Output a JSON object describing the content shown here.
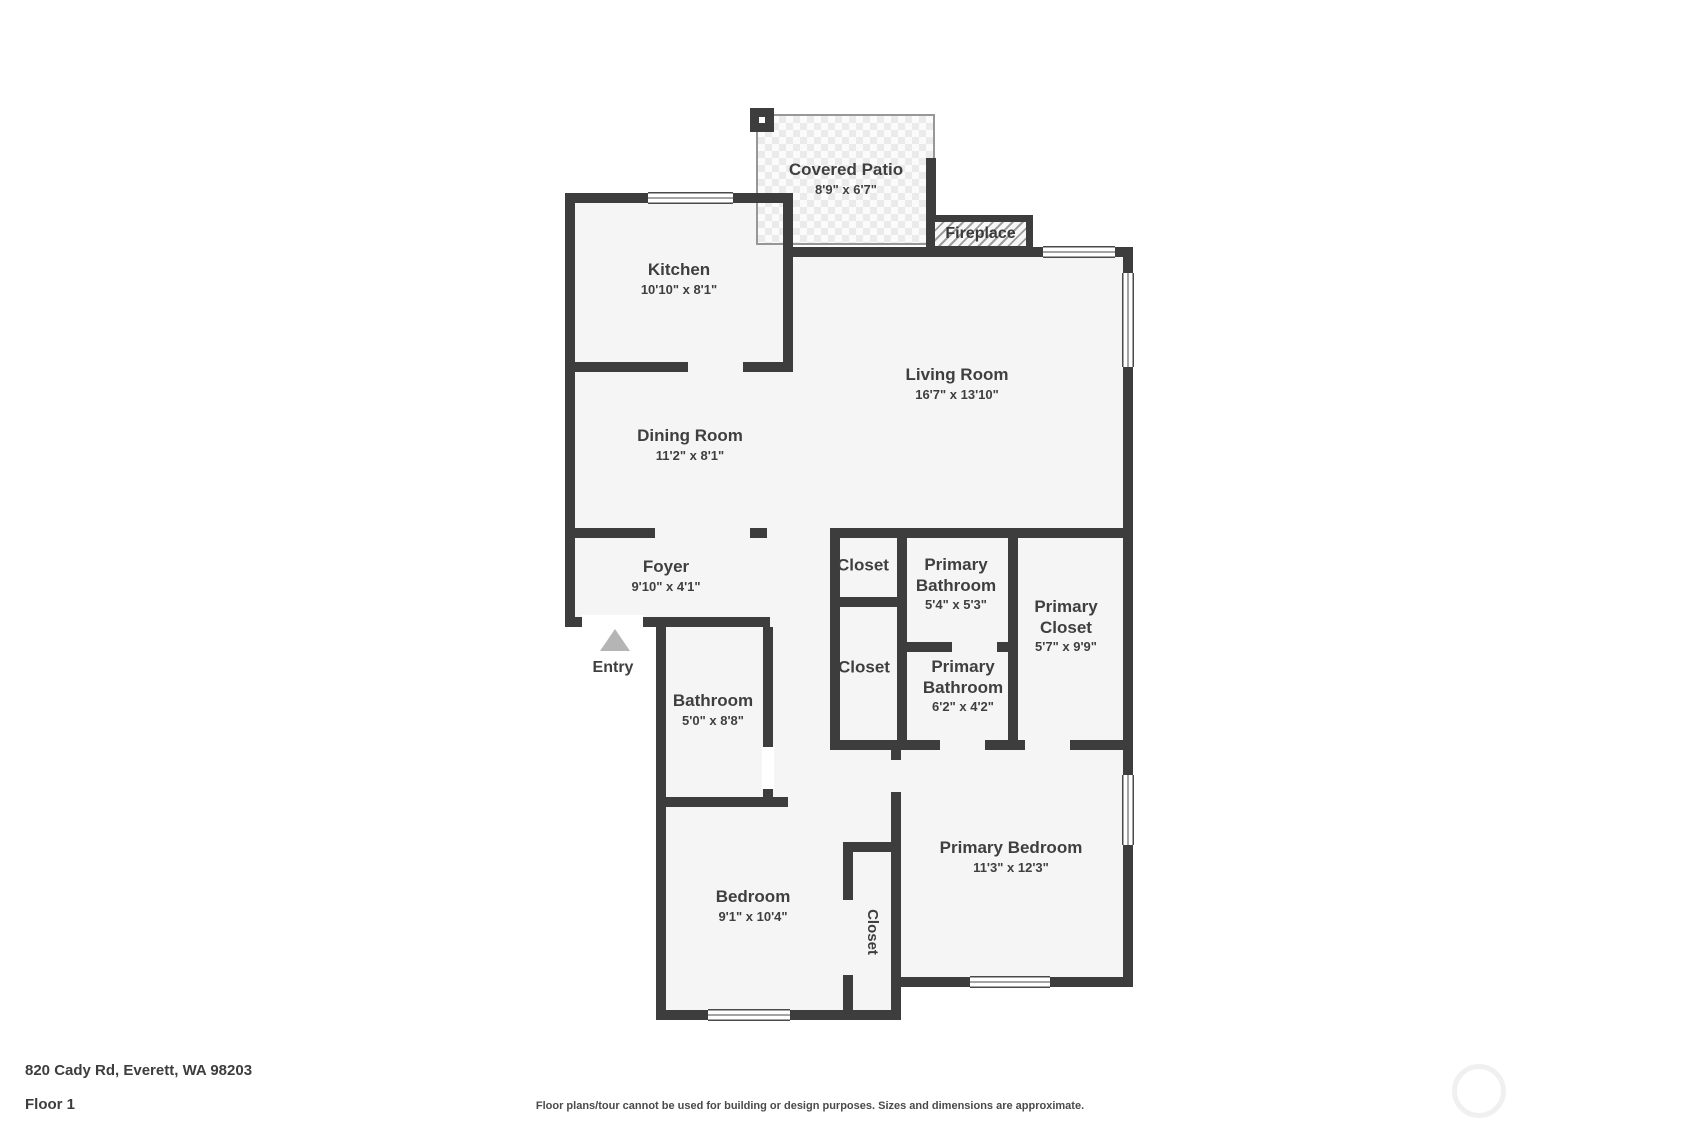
{
  "colors": {
    "wall": "#3d3d3d",
    "room_fill": "#f5f5f5",
    "label_text": "#3f3f3f",
    "entry_arrow": "#b5b5b5",
    "patio_tile": "#ebebeb",
    "watermark_ring": "#f0f0f0"
  },
  "rooms": {
    "covered_patio": {
      "name": "Covered Patio",
      "dims": "8'9\" x 6'7\""
    },
    "fireplace": {
      "name": "Fireplace"
    },
    "kitchen": {
      "name": "Kitchen",
      "dims": "10'10\" x 8'1\""
    },
    "living_room": {
      "name": "Living Room",
      "dims": "16'7\" x 13'10\""
    },
    "dining_room": {
      "name": "Dining Room",
      "dims": "11'2\" x 8'1\""
    },
    "foyer": {
      "name": "Foyer",
      "dims": "9'10\" x 4'1\""
    },
    "entry": {
      "name": "Entry"
    },
    "bathroom": {
      "name": "Bathroom",
      "dims": "5'0\" x 8'8\""
    },
    "closet_upper": {
      "name": "Closet"
    },
    "primary_bathroom_upper": {
      "name": "Primary Bathroom",
      "dims": "5'4\" x 5'3\""
    },
    "primary_closet": {
      "name": "Primary Closet",
      "dims": "5'7\" x 9'9\""
    },
    "closet_lower": {
      "name": "Closet"
    },
    "primary_bathroom_lower": {
      "name": "Primary Bathroom",
      "dims": "6'2\" x 4'2\""
    },
    "bedroom": {
      "name": "Bedroom",
      "dims": "9'1\" x 10'4\""
    },
    "bedroom_closet": {
      "name": "Closet"
    },
    "primary_bedroom": {
      "name": "Primary Bedroom",
      "dims": "11'3\" x 12'3\""
    }
  },
  "footer": {
    "address": "820 Cady Rd, Everett, WA 98203",
    "floor": "Floor 1",
    "disclaimer": "Floor plans/tour cannot be used for building or design purposes. Sizes and dimensions are approximate."
  }
}
